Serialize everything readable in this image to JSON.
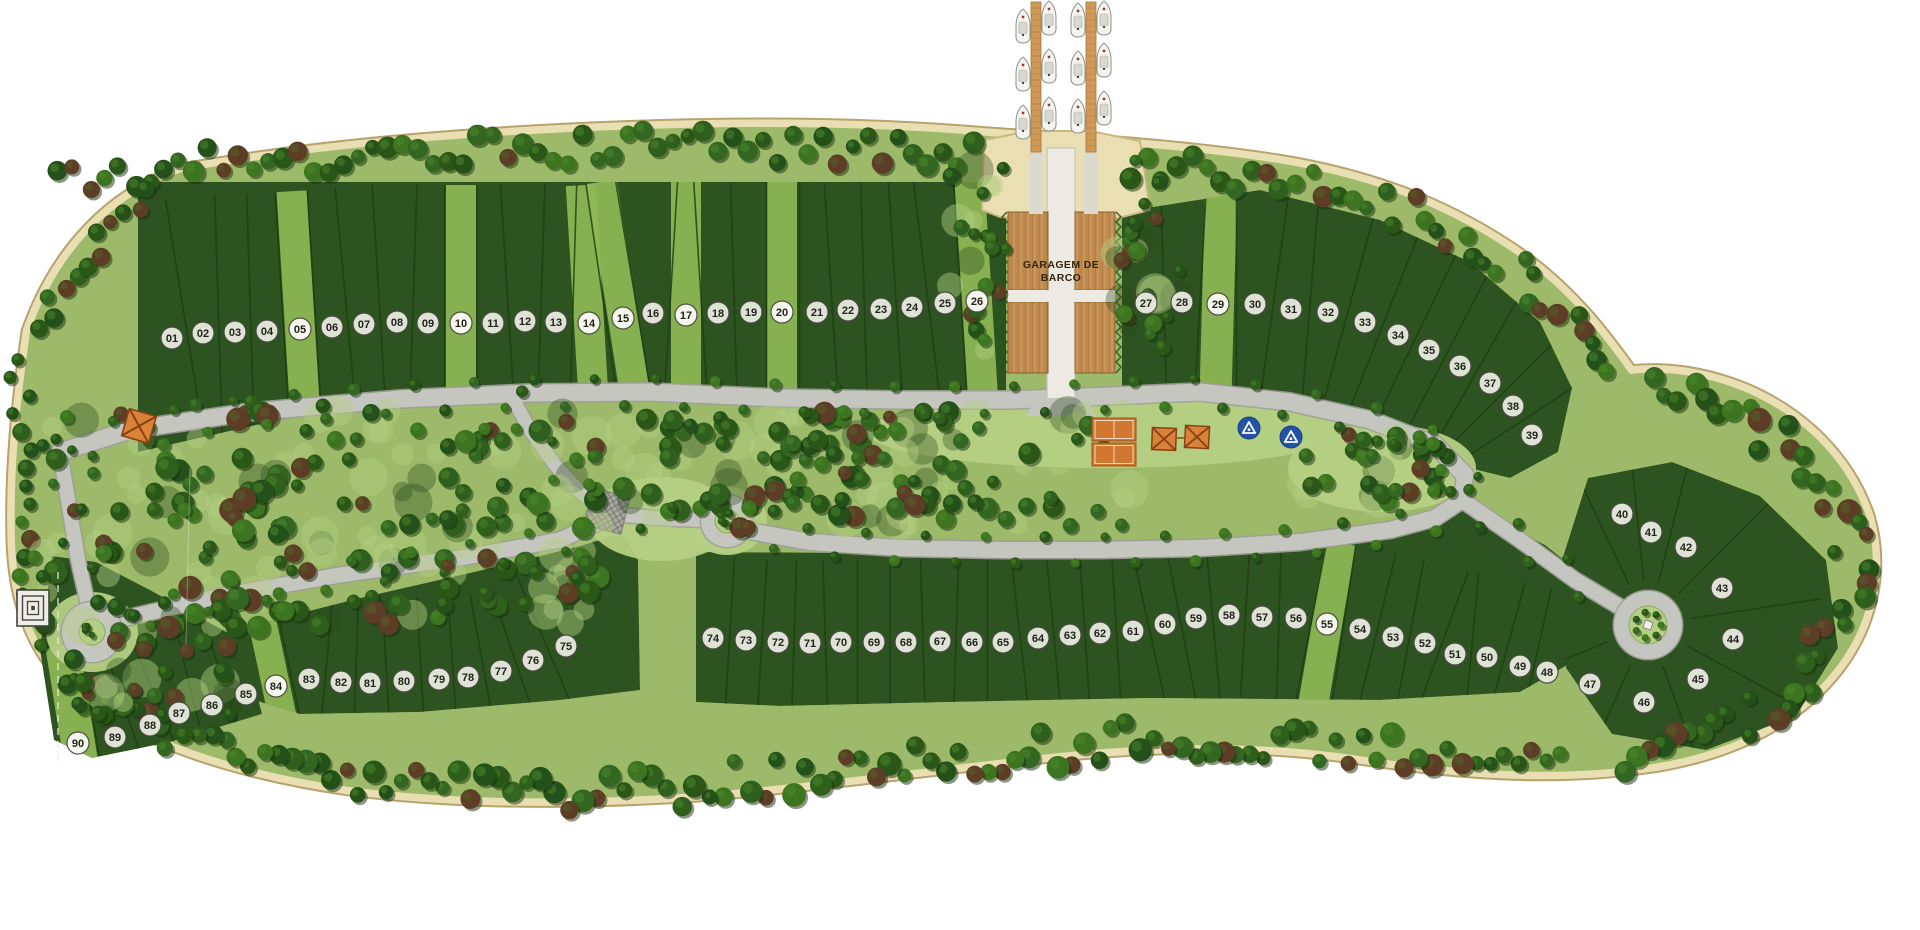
{
  "map": {
    "name": "Condominium masterplan with boat garage and marina piers",
    "garage_label": "GARAGEM DE BARCO",
    "garage_label_lines": [
      "GARAGEM DE",
      "BARCO"
    ],
    "lot_count": 90
  },
  "colors": {
    "background": "#ffffff",
    "sand": "#eadfb2",
    "sand_edge": "#b7a36d",
    "forest_floor": "#9cba69",
    "lawn": "#b5d084",
    "lot_green": "#2d5420",
    "lot_light_strip": "#8fb856",
    "divider": "#1e3d11",
    "road": "#c6c6c1",
    "road_casing": "#9e9e98",
    "road_white": "#eceae2",
    "wood": "#c9955a",
    "wood_dark": "#a9763c",
    "court_orange": "#d2772f",
    "pavilion_orange": "#d8823a",
    "pavilion_line": "#8a4012",
    "sign_blue": "#2253a8",
    "marker_fill": "#e9ebdf",
    "marker_light_fill": "#fbfbf6",
    "marker_stroke": "#4a4a44",
    "boat_hull": "#f4f4f1"
  },
  "amenities": [
    {
      "id": "boat-garage",
      "label": "GARAGEM DE BARCO"
    },
    {
      "id": "boat-pier",
      "count": 2
    },
    {
      "id": "moored-boat",
      "count": 12
    },
    {
      "id": "tennis-court",
      "count": 2
    },
    {
      "id": "pavilion",
      "count": 3
    },
    {
      "id": "park-sign",
      "count": 2
    },
    {
      "id": "labyrinth-structure",
      "count": 1
    },
    {
      "id": "cul-de-sac",
      "count": 3
    }
  ],
  "lots": [
    {
      "n": "01",
      "x": 172,
      "y": 338
    },
    {
      "n": "02",
      "x": 203,
      "y": 333
    },
    {
      "n": "03",
      "x": 235,
      "y": 332
    },
    {
      "n": "04",
      "x": 267,
      "y": 331
    },
    {
      "n": "05",
      "x": 300,
      "y": 329,
      "light": true
    },
    {
      "n": "06",
      "x": 332,
      "y": 327
    },
    {
      "n": "07",
      "x": 364,
      "y": 324
    },
    {
      "n": "08",
      "x": 397,
      "y": 322
    },
    {
      "n": "09",
      "x": 428,
      "y": 323
    },
    {
      "n": "10",
      "x": 461,
      "y": 323,
      "light": true
    },
    {
      "n": "11",
      "x": 493,
      "y": 323
    },
    {
      "n": "12",
      "x": 525,
      "y": 321
    },
    {
      "n": "13",
      "x": 556,
      "y": 322
    },
    {
      "n": "14",
      "x": 589,
      "y": 323,
      "light": true
    },
    {
      "n": "15",
      "x": 623,
      "y": 318,
      "light": true
    },
    {
      "n": "16",
      "x": 653,
      "y": 313
    },
    {
      "n": "17",
      "x": 686,
      "y": 315,
      "light": true
    },
    {
      "n": "18",
      "x": 718,
      "y": 313
    },
    {
      "n": "19",
      "x": 751,
      "y": 312
    },
    {
      "n": "20",
      "x": 782,
      "y": 312,
      "light": true
    },
    {
      "n": "21",
      "x": 817,
      "y": 312
    },
    {
      "n": "22",
      "x": 848,
      "y": 310
    },
    {
      "n": "23",
      "x": 881,
      "y": 309
    },
    {
      "n": "24",
      "x": 912,
      "y": 307
    },
    {
      "n": "25",
      "x": 945,
      "y": 303
    },
    {
      "n": "26",
      "x": 977,
      "y": 301,
      "light": true
    },
    {
      "n": "27",
      "x": 1146,
      "y": 303
    },
    {
      "n": "28",
      "x": 1182,
      "y": 302
    },
    {
      "n": "29",
      "x": 1218,
      "y": 304,
      "light": true
    },
    {
      "n": "30",
      "x": 1255,
      "y": 304
    },
    {
      "n": "31",
      "x": 1291,
      "y": 309
    },
    {
      "n": "32",
      "x": 1328,
      "y": 312
    },
    {
      "n": "33",
      "x": 1365,
      "y": 322
    },
    {
      "n": "34",
      "x": 1398,
      "y": 335
    },
    {
      "n": "35",
      "x": 1429,
      "y": 350
    },
    {
      "n": "36",
      "x": 1460,
      "y": 366
    },
    {
      "n": "37",
      "x": 1490,
      "y": 383
    },
    {
      "n": "38",
      "x": 1513,
      "y": 406
    },
    {
      "n": "39",
      "x": 1532,
      "y": 435
    },
    {
      "n": "40",
      "x": 1622,
      "y": 514
    },
    {
      "n": "41",
      "x": 1651,
      "y": 532
    },
    {
      "n": "42",
      "x": 1686,
      "y": 547
    },
    {
      "n": "43",
      "x": 1722,
      "y": 588
    },
    {
      "n": "44",
      "x": 1733,
      "y": 639
    },
    {
      "n": "45",
      "x": 1698,
      "y": 679
    },
    {
      "n": "46",
      "x": 1644,
      "y": 702
    },
    {
      "n": "47",
      "x": 1590,
      "y": 684
    },
    {
      "n": "48",
      "x": 1547,
      "y": 672
    },
    {
      "n": "49",
      "x": 1520,
      "y": 666
    },
    {
      "n": "50",
      "x": 1487,
      "y": 657
    },
    {
      "n": "51",
      "x": 1455,
      "y": 654
    },
    {
      "n": "52",
      "x": 1425,
      "y": 643
    },
    {
      "n": "53",
      "x": 1393,
      "y": 637
    },
    {
      "n": "54",
      "x": 1360,
      "y": 629
    },
    {
      "n": "55",
      "x": 1327,
      "y": 624,
      "light": true
    },
    {
      "n": "56",
      "x": 1296,
      "y": 618
    },
    {
      "n": "57",
      "x": 1262,
      "y": 617
    },
    {
      "n": "58",
      "x": 1229,
      "y": 615
    },
    {
      "n": "59",
      "x": 1196,
      "y": 618
    },
    {
      "n": "60",
      "x": 1165,
      "y": 624
    },
    {
      "n": "61",
      "x": 1133,
      "y": 631
    },
    {
      "n": "62",
      "x": 1100,
      "y": 633
    },
    {
      "n": "63",
      "x": 1070,
      "y": 635
    },
    {
      "n": "64",
      "x": 1038,
      "y": 638
    },
    {
      "n": "65",
      "x": 1003,
      "y": 642
    },
    {
      "n": "66",
      "x": 972,
      "y": 642
    },
    {
      "n": "67",
      "x": 940,
      "y": 641
    },
    {
      "n": "68",
      "x": 906,
      "y": 642
    },
    {
      "n": "69",
      "x": 874,
      "y": 642
    },
    {
      "n": "70",
      "x": 841,
      "y": 642
    },
    {
      "n": "71",
      "x": 810,
      "y": 643
    },
    {
      "n": "72",
      "x": 778,
      "y": 642
    },
    {
      "n": "73",
      "x": 746,
      "y": 640
    },
    {
      "n": "74",
      "x": 713,
      "y": 638
    },
    {
      "n": "75",
      "x": 566,
      "y": 646
    },
    {
      "n": "76",
      "x": 533,
      "y": 660
    },
    {
      "n": "77",
      "x": 501,
      "y": 671
    },
    {
      "n": "78",
      "x": 468,
      "y": 677
    },
    {
      "n": "79",
      "x": 439,
      "y": 679
    },
    {
      "n": "80",
      "x": 404,
      "y": 681
    },
    {
      "n": "81",
      "x": 370,
      "y": 683
    },
    {
      "n": "82",
      "x": 341,
      "y": 682
    },
    {
      "n": "83",
      "x": 309,
      "y": 679
    },
    {
      "n": "84",
      "x": 276,
      "y": 686,
      "light": true
    },
    {
      "n": "85",
      "x": 246,
      "y": 694
    },
    {
      "n": "86",
      "x": 212,
      "y": 705
    },
    {
      "n": "87",
      "x": 179,
      "y": 713
    },
    {
      "n": "88",
      "x": 150,
      "y": 725
    },
    {
      "n": "89",
      "x": 115,
      "y": 737
    },
    {
      "n": "90",
      "x": 78,
      "y": 743,
      "light": true
    }
  ]
}
